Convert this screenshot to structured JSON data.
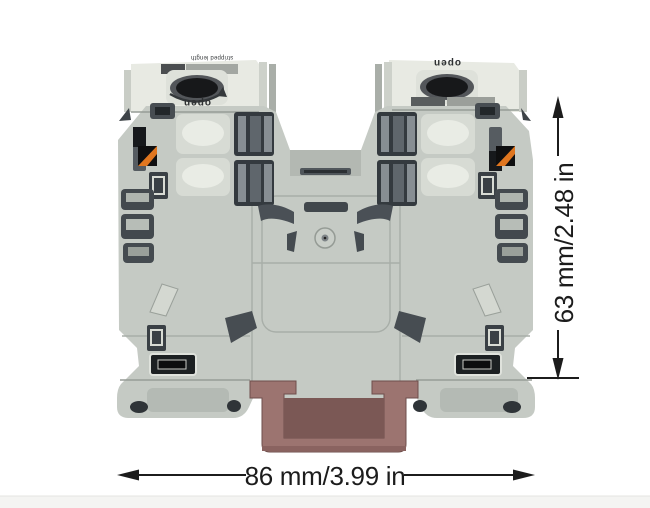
{
  "image": {
    "background_color": "#ffffff",
    "footer_strip_color": "#f4f4f2"
  },
  "product": {
    "colors": {
      "body": "#c5cac4",
      "tower": "#e8eae3",
      "recess": "#dee1da",
      "slot_dark": "#43494e",
      "clamp": "#9c7470",
      "clamp_inner": "#7b5855",
      "accent_orange": "#e0761f"
    },
    "left_tower": {
      "label": "open",
      "marking": "stripped length"
    },
    "right_tower": {
      "label": "open",
      "marking": "stripped length"
    }
  },
  "dimensions": {
    "color": "#1c1c1c",
    "height": {
      "label": "63 mm/2.48 in"
    },
    "width": {
      "label": "86 mm/3.99 in"
    }
  }
}
